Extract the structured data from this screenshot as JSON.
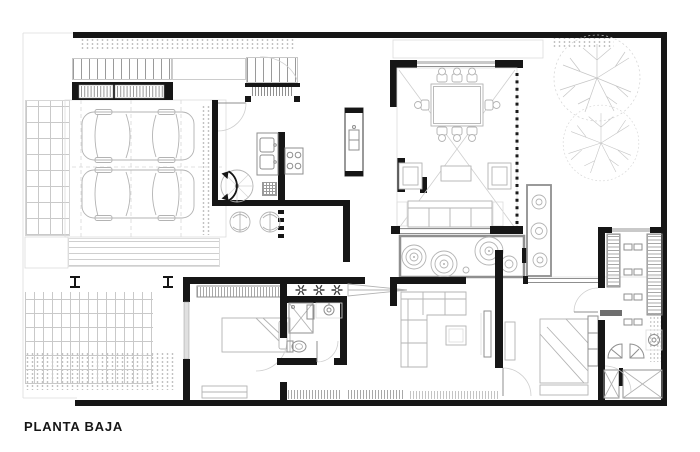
{
  "title": "PLANTA BAJA",
  "colors": {
    "walls": "#161616",
    "furniture_lines": "#b3b3b3",
    "fixture_lines": "#8f8f8f",
    "light_lines": "#dcdcdc",
    "hatch": "#a8a8a8",
    "paper": "#ffffff"
  }
}
